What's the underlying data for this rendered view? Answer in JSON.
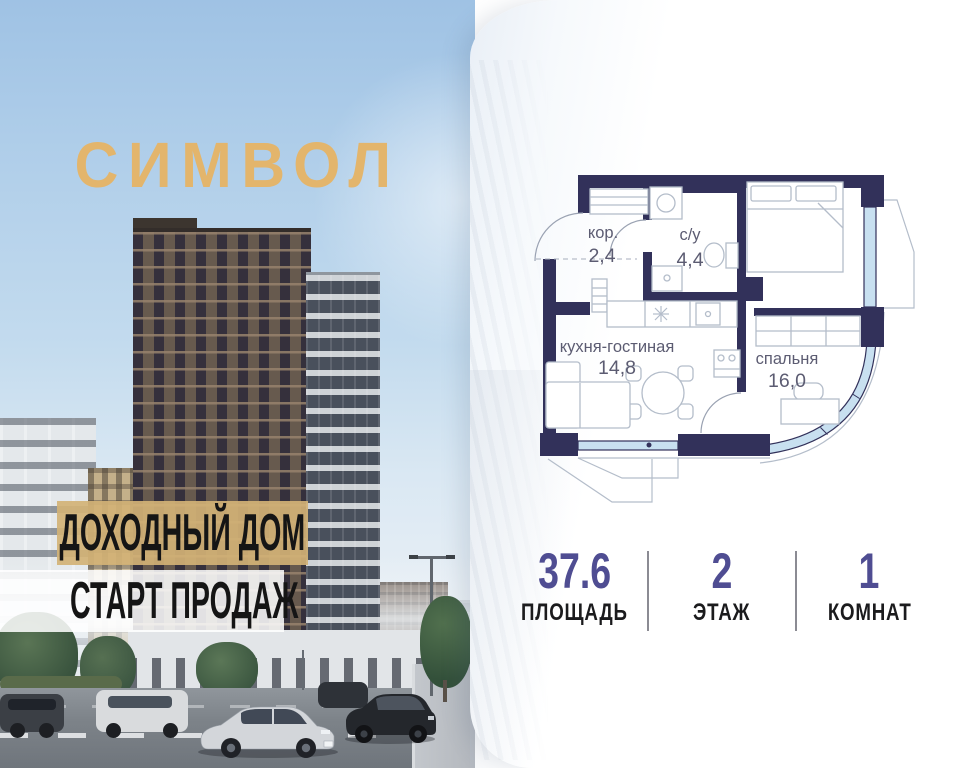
{
  "brand": {
    "logo": "СИМВОЛ",
    "logo_color": "#e3b56c"
  },
  "banners": {
    "line1": "ДОХОДНЫЙ ДОМ",
    "line2": "СТАРТ ПРОДАЖ"
  },
  "floorplan": {
    "rooms": [
      {
        "name": "кор.",
        "area": "2,4"
      },
      {
        "name": "с/у",
        "area": "4,4"
      },
      {
        "name": "кухня-гостиная",
        "area": "14,8"
      },
      {
        "name": "спальня",
        "area": "16,0"
      }
    ],
    "wall_color": "#32315a"
  },
  "stats": {
    "items": [
      {
        "value": "37.6",
        "label": "ПЛОЩАДЬ"
      },
      {
        "value": "2",
        "label": "ЭТАЖ"
      },
      {
        "value": "1",
        "label": "КОМНАТ"
      }
    ],
    "value_color": "#4f4d92"
  },
  "colors": {
    "banner_gold": "#d3b276",
    "sky": "#aecde9"
  }
}
